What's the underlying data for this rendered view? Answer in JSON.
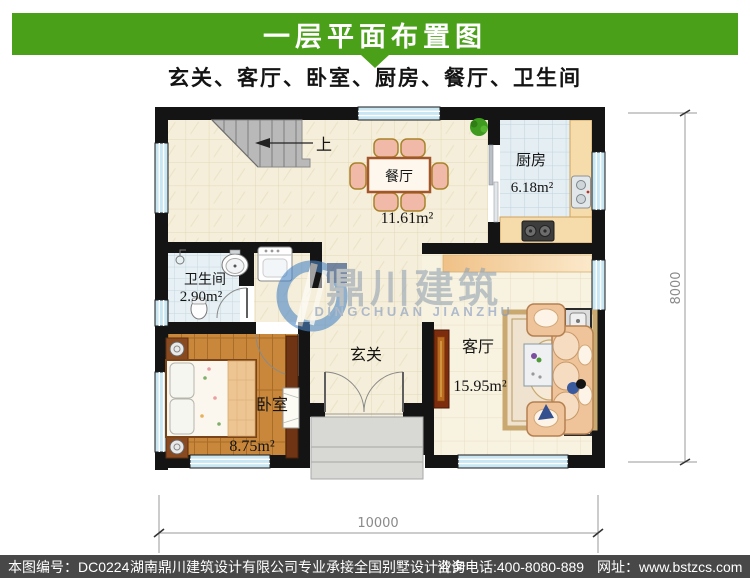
{
  "header": {
    "title": "一层平面布置图",
    "subtitle": "玄关、客厅、卧室、厨房、餐厅、卫生间",
    "accent_color": "#4ba019"
  },
  "plan": {
    "rooms": {
      "dining": {
        "name": "餐厅",
        "area": "11.61m²"
      },
      "kitchen": {
        "name": "厨房",
        "area": "6.18m²"
      },
      "bathroom": {
        "name": "卫生间",
        "area": "2.90m²"
      },
      "bedroom": {
        "name": "卧室",
        "area": "8.75m²"
      },
      "living": {
        "name": "客厅",
        "area": "15.95m²"
      },
      "entry": {
        "name": "玄关"
      }
    },
    "stairs": {
      "up_label": "上"
    },
    "dimensions": {
      "height": "8000",
      "width": "10000"
    }
  },
  "watermark": {
    "cn": "鼎川建筑",
    "en": "DINGCHUAN JIANZHU",
    "logo_color": "#4a86c5"
  },
  "footer": {
    "drawing_no": "本图编号：DC0224",
    "company": "湖南鼎川建筑设计有限公司专业承接全国别墅设计业务",
    "phone": "咨询电话:400-8080-889",
    "website": "网址：www.bstzcs.com",
    "bg_color": "#484848"
  }
}
